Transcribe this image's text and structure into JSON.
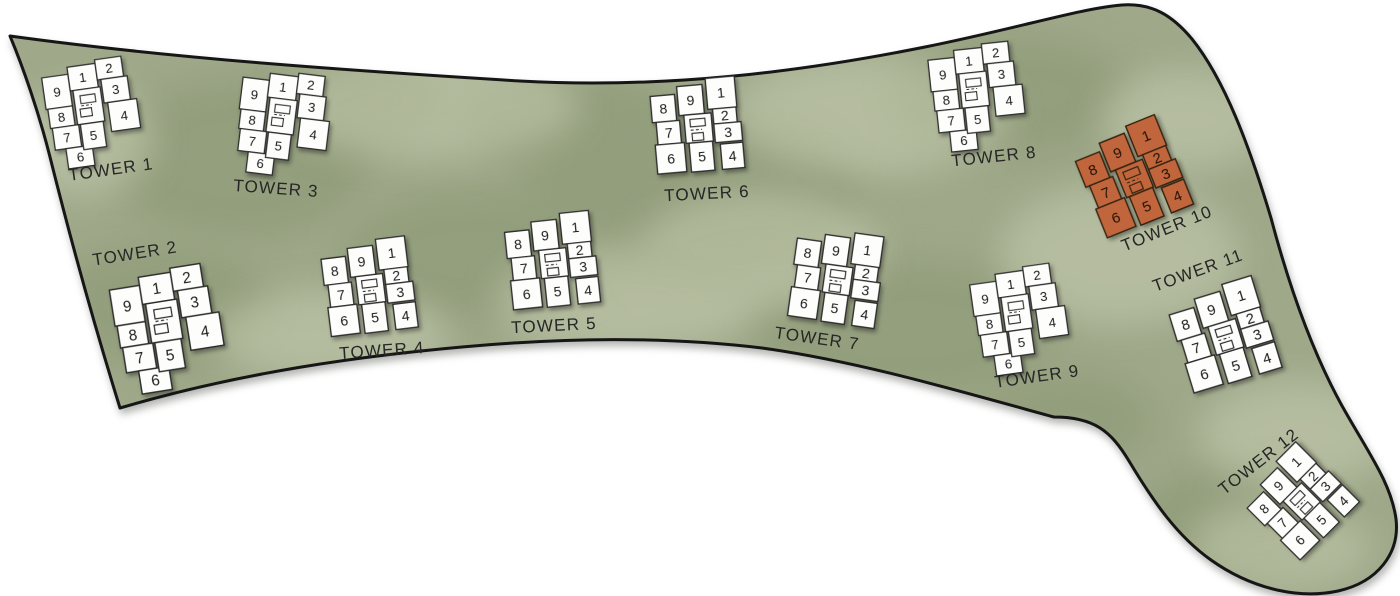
{
  "site": {
    "highlight_color": "#c1663c",
    "terrain_base_color": "#9fa98a",
    "terrain_texture_light_color": "#c6ccb1",
    "terrain_texture_dark_color": "#87946f",
    "outline_color": "#161616",
    "unit_number_color": "#1c1c1c",
    "label_color": "#262626",
    "highlighted_tower": "TOWER 10",
    "towers": [
      {
        "id": "tower-1",
        "label": "TOWER 1",
        "variant": "A",
        "highlighted": false,
        "unit_layout": {
          "left": [
            "9",
            "8",
            "7",
            "6"
          ],
          "middle": [
            "1",
            "5"
          ],
          "right": [
            "2",
            "3",
            "4"
          ]
        }
      },
      {
        "id": "tower-2",
        "label": "TOWER 2",
        "variant": "A",
        "highlighted": false,
        "unit_layout": {
          "left": [
            "9",
            "8",
            "7",
            "6"
          ],
          "middle": [
            "1",
            "5"
          ],
          "right": [
            "2",
            "3",
            "4"
          ]
        }
      },
      {
        "id": "tower-3",
        "label": "TOWER 3",
        "variant": "A",
        "highlighted": false,
        "unit_layout": {
          "left": [
            "9",
            "8",
            "7",
            "6"
          ],
          "middle": [
            "1",
            "5"
          ],
          "right": [
            "2",
            "3",
            "4"
          ]
        }
      },
      {
        "id": "tower-4",
        "label": "TOWER 4",
        "variant": "B",
        "highlighted": false,
        "unit_layout": {
          "left": [
            "8",
            "7",
            "6"
          ],
          "middle": [
            "9",
            "5"
          ],
          "right": [
            "1",
            "2",
            "3",
            "4"
          ]
        }
      },
      {
        "id": "tower-5",
        "label": "TOWER 5",
        "variant": "B",
        "highlighted": false,
        "unit_layout": {
          "left": [
            "8",
            "7",
            "6"
          ],
          "middle": [
            "9",
            "5"
          ],
          "right": [
            "1",
            "2",
            "3",
            "4"
          ]
        }
      },
      {
        "id": "tower-6",
        "label": "TOWER 6",
        "variant": "B",
        "highlighted": false,
        "unit_layout": {
          "left": [
            "8",
            "7",
            "6"
          ],
          "middle": [
            "9",
            "5"
          ],
          "right": [
            "1",
            "2",
            "3",
            "4"
          ]
        }
      },
      {
        "id": "tower-7",
        "label": "TOWER 7",
        "variant": "B",
        "highlighted": false,
        "unit_layout": {
          "left": [
            "8",
            "7",
            "6"
          ],
          "middle": [
            "9",
            "5"
          ],
          "right": [
            "1",
            "2",
            "3",
            "4"
          ]
        }
      },
      {
        "id": "tower-8",
        "label": "TOWER 8",
        "variant": "A",
        "highlighted": false,
        "unit_layout": {
          "left": [
            "9",
            "8",
            "7",
            "6"
          ],
          "middle": [
            "1",
            "5"
          ],
          "right": [
            "2",
            "3",
            "4"
          ]
        }
      },
      {
        "id": "tower-9",
        "label": "TOWER 9",
        "variant": "A",
        "highlighted": false,
        "unit_layout": {
          "left": [
            "9",
            "8",
            "7",
            "6"
          ],
          "middle": [
            "1",
            "5"
          ],
          "right": [
            "2",
            "3",
            "4"
          ]
        }
      },
      {
        "id": "tower-10",
        "label": "TOWER 10",
        "variant": "B",
        "highlighted": true,
        "unit_layout": {
          "left": [
            "8",
            "7",
            "6"
          ],
          "middle": [
            "9",
            "5"
          ],
          "right": [
            "1",
            "2",
            "3",
            "4"
          ]
        }
      },
      {
        "id": "tower-11",
        "label": "TOWER 11",
        "variant": "B",
        "highlighted": false,
        "unit_layout": {
          "left": [
            "8",
            "7",
            "6"
          ],
          "middle": [
            "9",
            "5"
          ],
          "right": [
            "1",
            "2",
            "3",
            "4"
          ]
        }
      },
      {
        "id": "tower-12",
        "label": "TOWER 12",
        "variant": "B",
        "highlighted": false,
        "unit_layout": {
          "left": [
            "8",
            "7",
            "6"
          ],
          "middle": [
            "9",
            "5"
          ],
          "right": [
            "1",
            "2",
            "3",
            "4"
          ]
        }
      }
    ]
  }
}
